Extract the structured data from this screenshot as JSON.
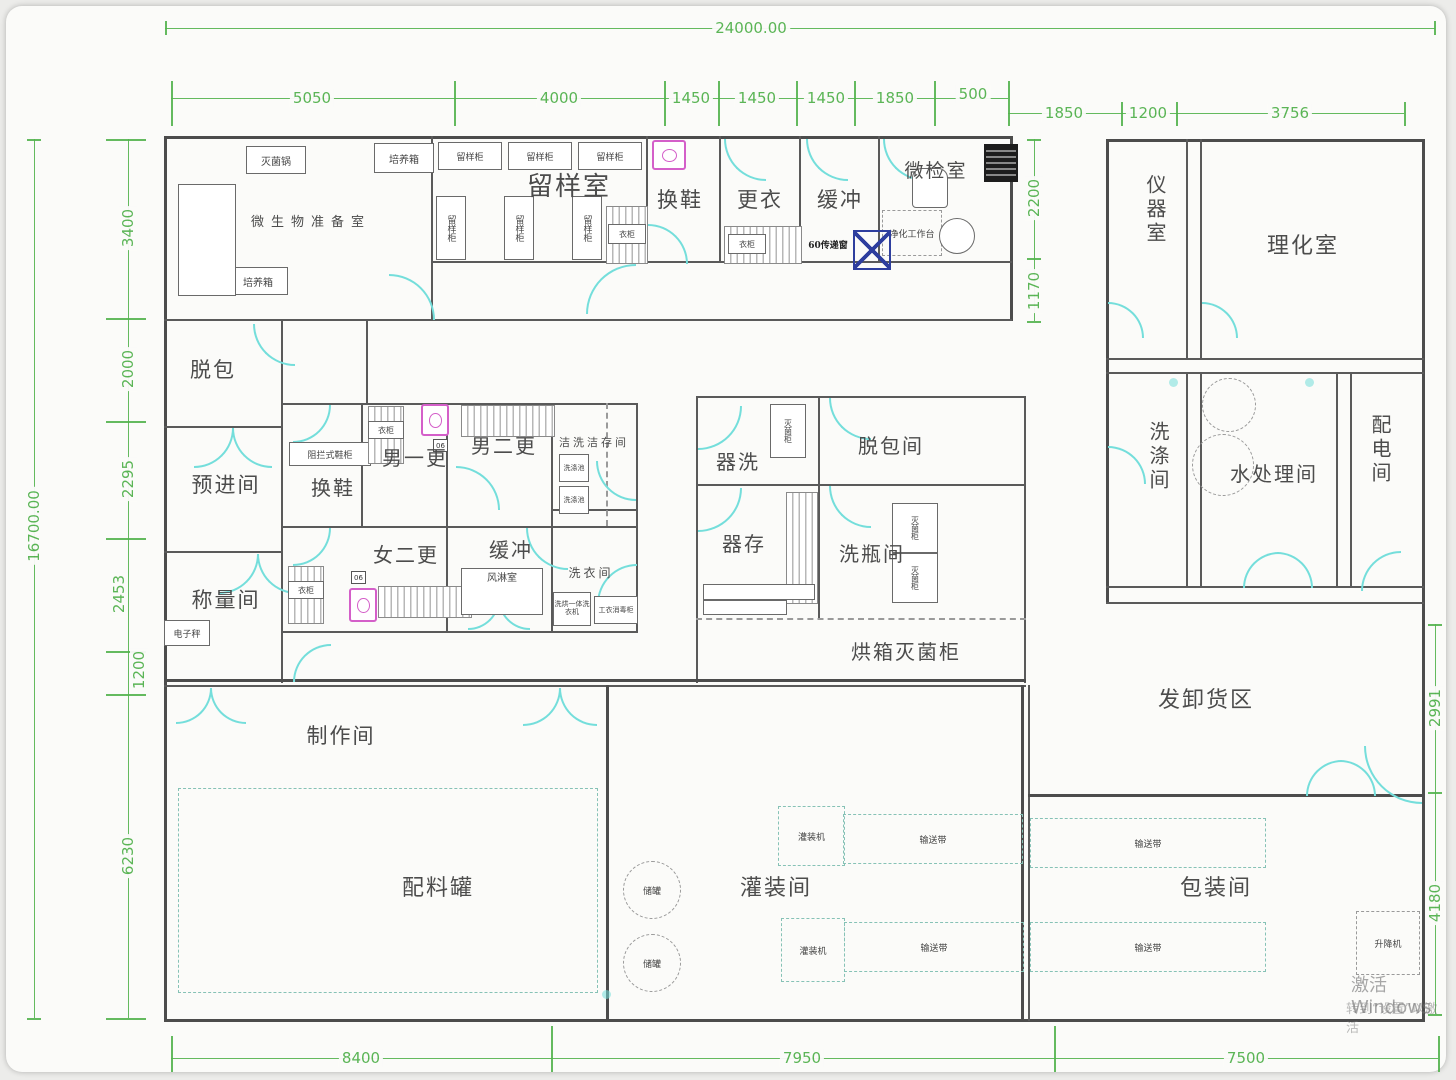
{
  "dimensions": {
    "top_overall": "24000.00",
    "top_segments": [
      "5050",
      "4000",
      "1450",
      "1450",
      "1450",
      "1850",
      "500"
    ],
    "top_segments2": [
      "1850",
      "1200",
      "3756"
    ],
    "left_overall": "16700.00",
    "left_segments": [
      "3400",
      "2000",
      "2295",
      "2453",
      "1200",
      "6230"
    ],
    "right_upper": [
      "2200",
      "1170"
    ],
    "right_lower": [
      "2991",
      "4180"
    ],
    "bottom_segments": [
      "8400",
      "7950",
      "7500"
    ]
  },
  "rooms": {
    "microbio_prep": "微生物准备室",
    "sample_room": "留样室",
    "shoe_change_top": "换鞋",
    "clothes_change": "更衣",
    "buffer_top": "缓冲",
    "micro_test": "微检室",
    "instrument_room": "仪器室",
    "physchem_lab": "理化室",
    "depack": "脱包",
    "pre_entry": "预进间",
    "weighing": "称量间",
    "shoe_change_mid": "换鞋",
    "men_first": "男一更",
    "men_second": "男二更",
    "women_second": "女二更",
    "buffer_mid": "缓冲",
    "clean_storage": "洁洗洁存间",
    "laundry": "洗衣间",
    "air_shower": "风淋室",
    "vessel_wash": "器洗",
    "depack_room": "脱包间",
    "vessel_store": "器存",
    "bottle_wash": "洗瓶间",
    "oven_sterilizer": "烘箱灭菌柜",
    "washing_room": "洗涤间",
    "water_treatment": "水处理间",
    "power_room": "配电间",
    "loading_area": "发卸货区",
    "production": "制作间",
    "mixing_tanks": "配料罐",
    "filling_room": "灌装间",
    "packing_room": "包装间"
  },
  "equipment": {
    "sterilizer_pot": "灭菌锅",
    "incubator": "培养箱",
    "sample_cabinet": "留样柜",
    "wardrobe": "衣柜",
    "shoe_cabinet": "阻拦式鞋柜",
    "electronic_scale": "电子秤",
    "wash_sink": "洗涤池",
    "washer_dryer": "洗烘一体洗衣机",
    "uniform_cabinet": "工衣消毒柜",
    "clean_bench": "净化工作台",
    "transfer_window": "60传递窗",
    "sterilize_cabinet": "灭菌柜",
    "filling_machine": "灌装机",
    "conveyor": "输送带",
    "storage_tank": "储罐",
    "lifter": "升降机",
    "door_tag": "06"
  },
  "watermark": {
    "line1": "激活 Windows",
    "line2": "转到“设置”以激活"
  }
}
